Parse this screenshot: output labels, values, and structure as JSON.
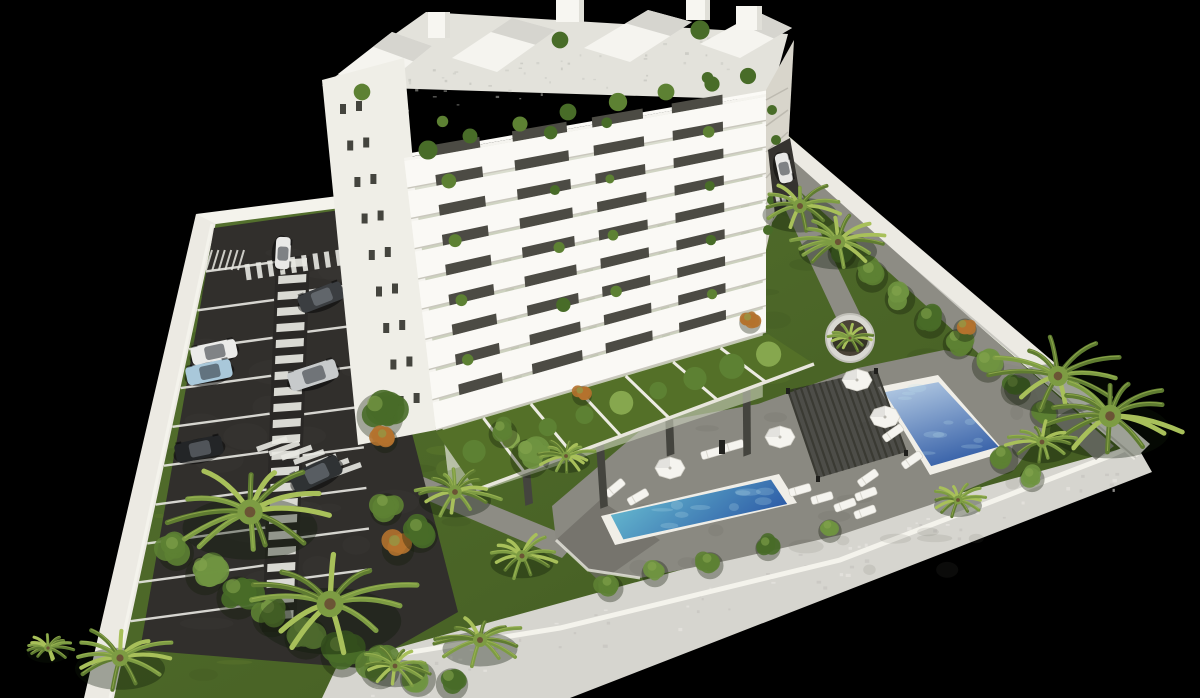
{
  "scene": {
    "kind": "aerial-3d-architectural-render",
    "subject": "white-apartment-building-with-parking-gardens-and-pools",
    "background_color": "#000000",
    "canvas": {
      "width": 1200,
      "height": 698
    }
  },
  "palette": {
    "facade_white": "#f5f4ef",
    "facade_side": "#efeee7",
    "facade_shadow": "#d8d5cb",
    "window_dark": "#44443e",
    "interior_dark": "#4c4b44",
    "railing_glass": "rgba(202,206,188,0.62)",
    "slab": "#faf9f5",
    "slab_edge": "#c9c7bd",
    "roof_band": "#e3e2db",
    "roof_terrace": "#d6d5cf",
    "volume_side": "#e0dfd8",
    "grass": "#4c6526",
    "grass_dark": "#3c5220",
    "grass_light": "#68862f",
    "asphalt": "#312f2c",
    "asphalt_light": "#3b3936",
    "marking_white": "#e8e8e2",
    "wall_white": "#eceae3",
    "wall_bright": "#f4f3ec",
    "wall_gray": "#d6d5cf",
    "path_gray": "#8d8c84",
    "deck_gray": "#8a8981",
    "deck_dark": "#6f6e67",
    "pool_rim": "#f0eee7",
    "water_light": "#6fc9d6",
    "water_deep": "#2f5ea8",
    "water2_light": "#b9cfe6",
    "water2_deep": "#3d66ab",
    "pergola_dark": "#1f1f1c",
    "pergola_slat": "#3a3a33",
    "furniture_white": "#f5f4ef",
    "palm_dark": "#5f7c31",
    "palm_mid": "#7d9c43",
    "palm_light": "#a8c05a",
    "bush_green": "#5d8133",
    "bush_green2": "#6f9440",
    "bush_deep": "#486c28",
    "bush_pale": "#86a74e",
    "bush_orange": "#b4722e",
    "trunk_brown": "#6b5435"
  },
  "plot": {
    "outline": [
      [
        204,
        220
      ],
      [
        360,
        194
      ],
      [
        768,
        118
      ],
      [
        1144,
        446
      ],
      [
        566,
        698
      ],
      [
        96,
        698
      ]
    ]
  },
  "walls": {
    "left": [
      [
        196,
        214
      ],
      [
        216,
        222
      ],
      [
        114,
        698
      ],
      [
        84,
        698
      ]
    ],
    "top": [
      [
        196,
        214
      ],
      [
        354,
        194
      ],
      [
        356,
        206
      ],
      [
        216,
        224
      ]
    ],
    "divider": [
      [
        342,
        198
      ],
      [
        358,
        196
      ],
      [
        378,
        598
      ],
      [
        362,
        604
      ]
    ],
    "top_right": [
      [
        770,
        146
      ],
      [
        786,
        134
      ],
      [
        1150,
        444
      ],
      [
        1134,
        460
      ]
    ],
    "bottom": [
      [
        1136,
        444
      ],
      [
        1152,
        472
      ],
      [
        570,
        698
      ],
      [
        322,
        698
      ],
      [
        338,
        664
      ],
      [
        1110,
        452
      ]
    ],
    "bottom_inner_edge": [
      [
        338,
        664
      ],
      [
        560,
        628
      ],
      [
        840,
        560
      ],
      [
        1110,
        456
      ],
      [
        1136,
        444
      ]
    ]
  },
  "paths": [
    {
      "name": "wall-side-path",
      "pts": [
        [
          772,
          166
        ],
        [
          788,
          156
        ],
        [
          1114,
          446
        ],
        [
          1096,
          460
        ]
      ]
    },
    {
      "name": "garden-path",
      "pts": [
        [
          780,
          198
        ],
        [
          800,
          190
        ],
        [
          862,
          318
        ],
        [
          842,
          330
        ]
      ]
    },
    {
      "name": "parking-exit-path",
      "pts": [
        [
          352,
          468
        ],
        [
          372,
          456
        ],
        [
          578,
          540
        ],
        [
          562,
          558
        ]
      ]
    }
  ],
  "parking": {
    "asphalt": [
      [
        214,
        228
      ],
      [
        354,
        208
      ],
      [
        458,
        612
      ],
      [
        360,
        668
      ],
      [
        140,
        650
      ]
    ],
    "left_wall_inner": [
      [
        216,
        224
      ],
      [
        114,
        698
      ]
    ],
    "walkway": {
      "top": [
        293,
        260
      ],
      "bottom": [
        279,
        628
      ],
      "width": 34,
      "bars": 23
    },
    "left_stalls": 10,
    "right_stalls": 8,
    "moto_bays": 6,
    "cars": [
      {
        "x": 283,
        "y": 253,
        "angle": 93,
        "len": 32,
        "wid": 15,
        "color": "#e9e9e7",
        "name": "white-car-driving"
      },
      {
        "x": 321,
        "y": 297,
        "angle": -21,
        "len": 46,
        "wid": 19,
        "color": "#3b3e41",
        "name": "dark-gray-sedan"
      },
      {
        "x": 214,
        "y": 352,
        "angle": -12,
        "len": 46,
        "wid": 19,
        "color": "#ebebe9",
        "name": "white-car"
      },
      {
        "x": 209,
        "y": 372,
        "angle": -12,
        "len": 46,
        "wid": 19,
        "color": "#a9c8da",
        "name": "light-blue-car"
      },
      {
        "x": 313,
        "y": 375,
        "angle": -18,
        "len": 50,
        "wid": 20,
        "color": "#c7cacb",
        "name": "silver-car"
      },
      {
        "x": 199,
        "y": 449,
        "angle": -12,
        "len": 48,
        "wid": 20,
        "color": "#232527",
        "name": "black-car"
      },
      {
        "x": 316,
        "y": 474,
        "angle": -25,
        "len": 52,
        "wid": 21,
        "color": "#2f3234",
        "name": "dark-car"
      },
      {
        "x": 784,
        "y": 168,
        "angle": 78,
        "len": 30,
        "wid": 14,
        "color": "#e8e8e6",
        "name": "white-car-entrance"
      }
    ]
  },
  "building": {
    "floors": 9,
    "left_facade": [
      [
        322,
        80
      ],
      [
        404,
        58
      ],
      [
        436,
        430
      ],
      [
        358,
        445
      ]
    ],
    "se_facade": {
      "tl": [
        404,
        158
      ],
      "tr": [
        766,
        94
      ],
      "br": [
        766,
        332
      ],
      "bl": [
        436,
        430
      ]
    },
    "right_face": [
      [
        766,
        90
      ],
      [
        794,
        40
      ],
      [
        788,
        150
      ],
      [
        766,
        250
      ]
    ],
    "roof_band": [
      [
        322,
        86
      ],
      [
        426,
        12
      ],
      [
        788,
        34
      ],
      [
        770,
        100
      ]
    ],
    "volumes": [
      [
        [
          338,
          74
        ],
        [
          392,
          32
        ],
        [
          432,
          46
        ],
        [
          378,
          90
        ]
      ],
      [
        [
          452,
          58
        ],
        [
          512,
          18
        ],
        [
          556,
          30
        ],
        [
          497,
          72
        ]
      ],
      [
        [
          584,
          48
        ],
        [
          648,
          10
        ],
        [
          692,
          22
        ],
        [
          630,
          62
        ]
      ],
      [
        [
          700,
          44
        ],
        [
          758,
          12
        ],
        [
          792,
          28
        ],
        [
          740,
          58
        ]
      ]
    ],
    "chimneys": [
      [
        428,
        12,
        22,
        26
      ],
      [
        556,
        0,
        28,
        22
      ],
      [
        686,
        0,
        24,
        20
      ],
      [
        736,
        6,
        26,
        24
      ]
    ],
    "left_windows_rows": 9,
    "bays": [
      [
        0,
        0.08
      ],
      [
        0.21,
        0.3
      ],
      [
        0.45,
        0.52
      ],
      [
        0.66,
        0.74
      ],
      [
        0.88,
        1.0
      ]
    ],
    "glass_bays": [
      [
        0.08,
        0.21
      ],
      [
        0.3,
        0.45
      ],
      [
        0.52,
        0.66
      ],
      [
        0.74,
        0.88
      ]
    ],
    "roof_plants": [
      [
        428,
        150
      ],
      [
        470,
        136
      ],
      [
        520,
        124
      ],
      [
        568,
        112
      ],
      [
        618,
        102
      ],
      [
        666,
        92
      ],
      [
        712,
        84
      ],
      [
        748,
        76
      ],
      [
        362,
        92
      ],
      [
        560,
        40
      ],
      [
        700,
        30
      ]
    ],
    "right_face_plants": [
      [
        772,
        110
      ],
      [
        776,
        140
      ],
      [
        780,
        170
      ],
      [
        772,
        200
      ],
      [
        768,
        230
      ]
    ]
  },
  "gardens": {
    "strip": [
      [
        436,
        432
      ],
      [
        768,
        334
      ],
      [
        814,
        364
      ],
      [
        476,
        490
      ]
    ],
    "dividers": 6,
    "hedges": 9
  },
  "amenities": {
    "deck": [
      [
        552,
        506
      ],
      [
        648,
        424
      ],
      [
        758,
        404
      ],
      [
        858,
        368
      ],
      [
        944,
        350
      ],
      [
        1026,
        368
      ],
      [
        1048,
        424
      ],
      [
        1014,
        470
      ],
      [
        930,
        505
      ],
      [
        840,
        535
      ],
      [
        730,
        560
      ],
      [
        640,
        578
      ],
      [
        588,
        570
      ],
      [
        556,
        540
      ]
    ],
    "deck_dark_patch": [
      [
        556,
        540
      ],
      [
        600,
        500
      ],
      [
        660,
        540
      ],
      [
        600,
        582
      ]
    ],
    "pools": [
      {
        "name": "main-pool",
        "outer": [
          [
            601,
            516
          ],
          [
            779,
            474
          ],
          [
            797,
            503
          ],
          [
            615,
            545
          ]
        ],
        "light": "#6fc9d6",
        "deep": "#2f5ea8"
      },
      {
        "name": "second-pool",
        "outer": [
          [
            878,
            387
          ],
          [
            938,
            375
          ],
          [
            1005,
            452
          ],
          [
            930,
            475
          ]
        ],
        "light": "#b9cfe6",
        "deep": "#3d66ab"
      }
    ],
    "pergola": {
      "outline": [
        [
          788,
          390
        ],
        [
          876,
          370
        ],
        [
          906,
          452
        ],
        [
          818,
          478
        ]
      ],
      "slats": 14
    },
    "umbrellas": [
      [
        670,
        468
      ],
      [
        780,
        437
      ],
      [
        857,
        380
      ],
      [
        885,
        417
      ]
    ],
    "loungers": [
      [
        712,
        453,
        -16
      ],
      [
        733,
        446,
        -16
      ],
      [
        800,
        490,
        -16
      ],
      [
        822,
        498,
        -16
      ],
      [
        845,
        505,
        -20
      ],
      [
        865,
        512,
        -20
      ],
      [
        868,
        478,
        -35
      ],
      [
        893,
        433,
        -35
      ],
      [
        912,
        460,
        -35
      ],
      [
        866,
        494,
        -20
      ],
      [
        615,
        488,
        -40
      ],
      [
        638,
        497,
        -30
      ]
    ],
    "shower_post": [
      722,
      448
    ]
  },
  "landscape": {
    "planter": {
      "x": 850,
      "y": 338,
      "r": 24
    },
    "palms": [
      [
        250,
        512,
        90
      ],
      [
        330,
        604,
        95
      ],
      [
        120,
        658,
        60
      ],
      [
        48,
        648,
        28
      ],
      [
        455,
        492,
        48
      ],
      [
        522,
        556,
        42
      ],
      [
        566,
        456,
        32
      ],
      [
        480,
        640,
        50
      ],
      [
        395,
        666,
        40
      ],
      [
        800,
        206,
        50
      ],
      [
        838,
        242,
        52
      ],
      [
        1058,
        376,
        72
      ],
      [
        1110,
        416,
        80
      ],
      [
        1042,
        442,
        40
      ],
      [
        958,
        500,
        32
      ]
    ],
    "bushes": [
      [
        176,
        548,
        20,
        "g"
      ],
      [
        205,
        570,
        22,
        "g2"
      ],
      [
        238,
        592,
        24,
        "d"
      ],
      [
        272,
        612,
        22,
        "g"
      ],
      [
        306,
        632,
        24,
        "g2"
      ],
      [
        342,
        650,
        24,
        "d"
      ],
      [
        380,
        664,
        22,
        "g"
      ],
      [
        418,
        674,
        20,
        "g2"
      ],
      [
        452,
        680,
        18,
        "d"
      ],
      [
        398,
        545,
        18,
        "o"
      ],
      [
        380,
        410,
        26,
        "d"
      ],
      [
        385,
        437,
        14,
        "o"
      ],
      [
        503,
        430,
        16,
        "g"
      ],
      [
        530,
        453,
        22,
        "g2"
      ],
      [
        386,
        505,
        18,
        "g"
      ],
      [
        420,
        530,
        20,
        "d"
      ],
      [
        842,
        250,
        16,
        "d"
      ],
      [
        872,
        272,
        18,
        "g"
      ],
      [
        900,
        295,
        17,
        "g2"
      ],
      [
        930,
        318,
        18,
        "d"
      ],
      [
        958,
        340,
        17,
        "g"
      ],
      [
        965,
        327,
        13,
        "o"
      ],
      [
        988,
        362,
        18,
        "g2"
      ],
      [
        1016,
        386,
        17,
        "d"
      ],
      [
        1044,
        410,
        16,
        "g"
      ],
      [
        610,
        585,
        15,
        "g"
      ],
      [
        655,
        570,
        15,
        "g2"
      ],
      [
        710,
        562,
        15,
        "g"
      ],
      [
        768,
        545,
        14,
        "d"
      ],
      [
        830,
        528,
        13,
        "g2"
      ],
      [
        1004,
        456,
        16,
        "g"
      ],
      [
        1032,
        476,
        14,
        "g2"
      ],
      [
        750,
        320,
        12,
        "o"
      ],
      [
        582,
        393,
        11,
        "o"
      ]
    ]
  }
}
